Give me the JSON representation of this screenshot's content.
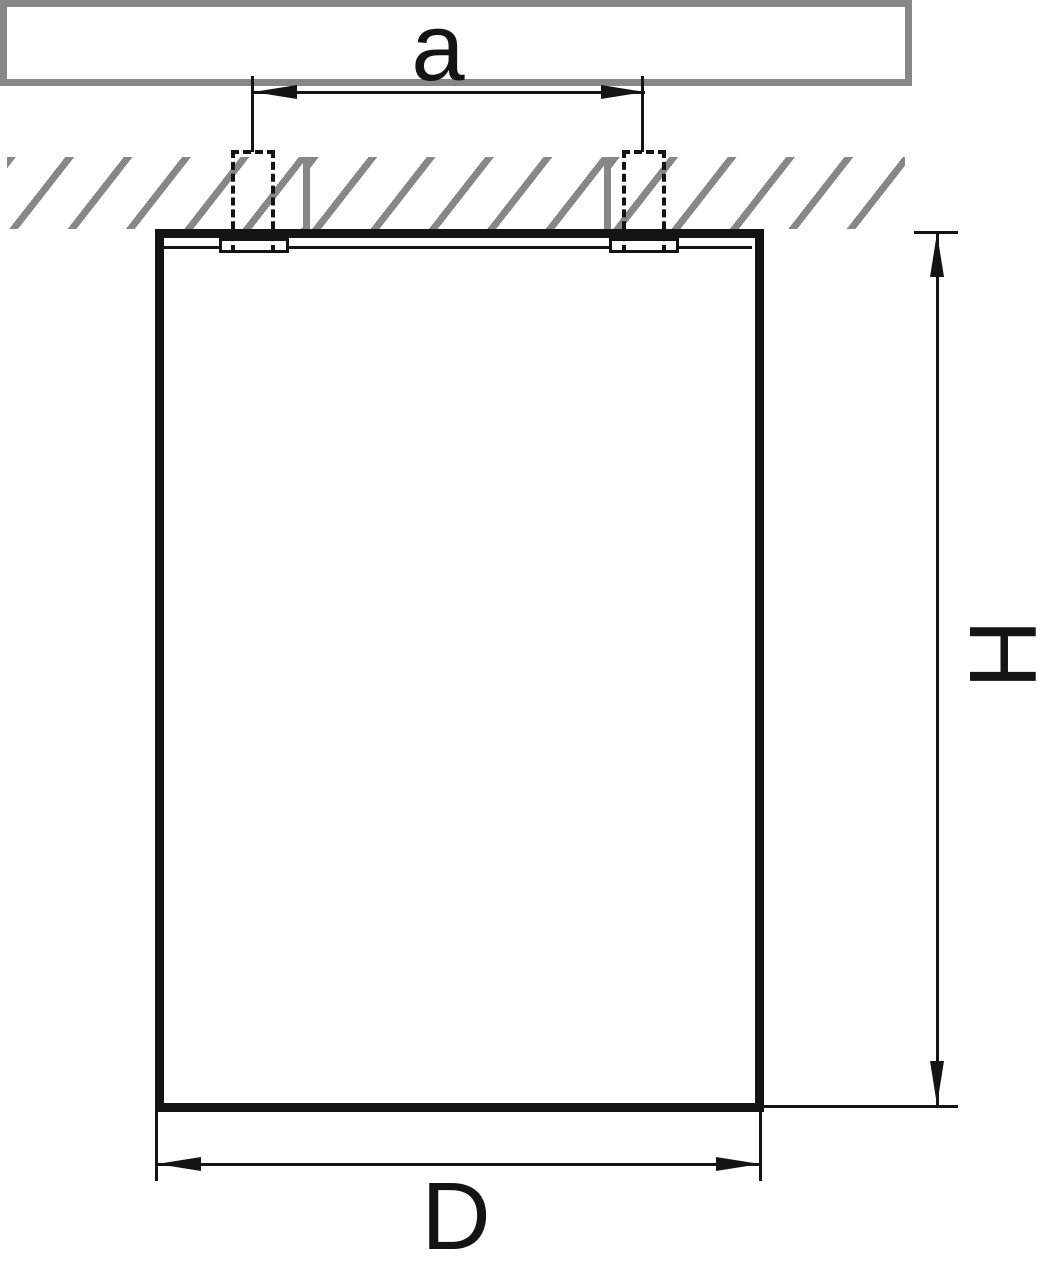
{
  "drawing": {
    "type": "technical dimension diagram",
    "subject": "Surface-mounted ceiling cylinder fixture, sectional side view with mounting holes in ceiling slab",
    "labels": {
      "hole_spacing": "a",
      "height": "H",
      "diameter": "D"
    },
    "colors": {
      "line": "#141414",
      "hatch_gray": "#878787",
      "background": "#ffffff"
    },
    "features": {
      "ceiling": "hatched slab with two cut lines and two dashed mounting holes",
      "body": "rectangular fixture outline with top mounting flange and two spring clips",
      "dimensions": [
        "a between hole centers (top)",
        "H fixture height (right, rotated label)",
        "D fixture diameter (bottom)"
      ]
    }
  }
}
